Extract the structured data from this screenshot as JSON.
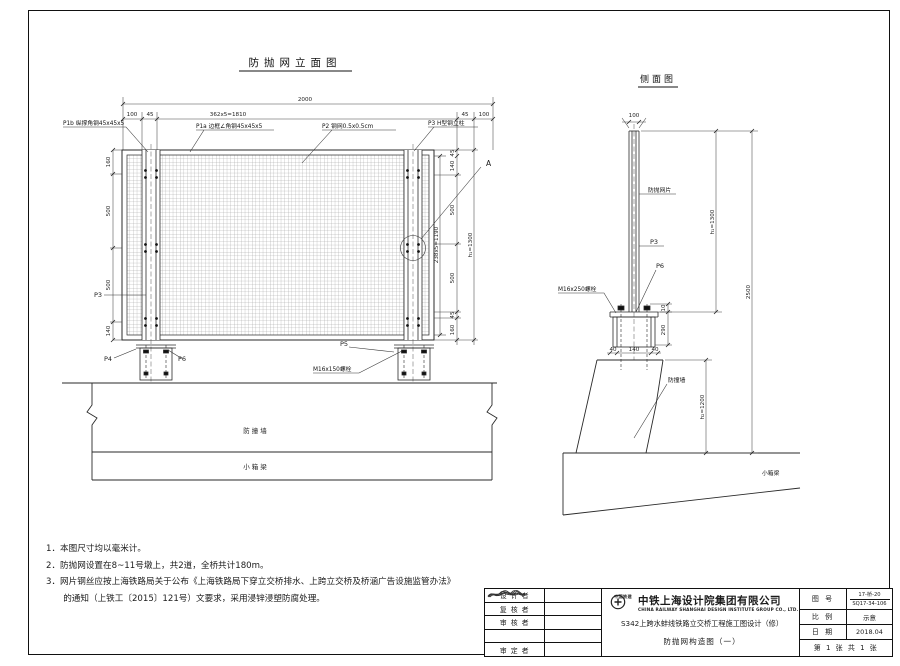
{
  "sheet": {
    "elevation": {
      "title": "防抛网立面图",
      "dims": {
        "overall": "2000",
        "mesh_top": "362x5=1810",
        "l100": "100",
        "l45": "45",
        "r45": "45",
        "r100": "100",
        "left": [
          "160",
          "500",
          "500",
          "140"
        ],
        "right_mid": "238x5=1190",
        "right": [
          "45",
          "140",
          "500",
          "500",
          "45",
          "160"
        ],
        "h1": "h₁=1300"
      },
      "labels": {
        "p1b": "P1b 纵撑角钢45x45x5",
        "p1a": "P1a 边框∠角钢45x45x5",
        "p2": "P2 钢网0.5x0.5cm",
        "p3h": "P3 H型钢立柱",
        "a": "A",
        "p3": "P3",
        "p4": "P4",
        "p5": "P5",
        "p6": "P6",
        "m16": "M16x150螺栓",
        "wall": "防撞墙",
        "girder": "小箱梁"
      }
    },
    "side": {
      "title": "侧面图",
      "dims": {
        "top": "100",
        "t10": "10",
        "t290": "290",
        "b40a": "40",
        "b140": "140",
        "b40b": "40",
        "h1": "h₁=1300",
        "h2": "h₂=1200",
        "overall": "2500"
      },
      "labels": {
        "mesh": "防抛网片",
        "p3": "P3",
        "p6": "P6",
        "m16": "M16x250螺栓",
        "wall": "防撞墙",
        "girder": "小箱梁"
      }
    },
    "notes": [
      "1．本图尺寸均以毫米计。",
      "2．防抛网设置在8~11号墩上，共2道，全桥共计180m。",
      "3．网片钢丝应按上海铁路局关于公布《上海铁路局下穿立交桥排水、上跨立交桥及桥涵广告设施监管办法》",
      "　　的通知（上铁工〔2015〕121号）文要求，采用浸锌浸塑防腐处理。"
    ],
    "titleblock": {
      "roles": [
        {
          "label": "设 计 者"
        },
        {
          "label": "复 核 者"
        },
        {
          "label": "审 核 者"
        },
        {
          "label": ""
        },
        {
          "label": "审 定 者"
        }
      ],
      "logo_text": "中国铁建",
      "company": "中铁上海设计院集团有限公司",
      "company_en": "CHINA RAILWAY SHANGHAI DESIGN INSTITUTE GROUP CO., LTD.",
      "project": "S342上跨水蚌线铁路立交桥工程施工图设计（修）",
      "drawing": "防抛网构造图（一）",
      "fields": {
        "no_label": "图  号",
        "no_value1": "17-桥-20",
        "no_value2": "SQ17-34-106",
        "scale_label": "比  例",
        "scale_value": "示意",
        "date_label": "日  期",
        "date_value": "2018.04",
        "sheet": "第 1 张 共 1 张"
      }
    }
  }
}
